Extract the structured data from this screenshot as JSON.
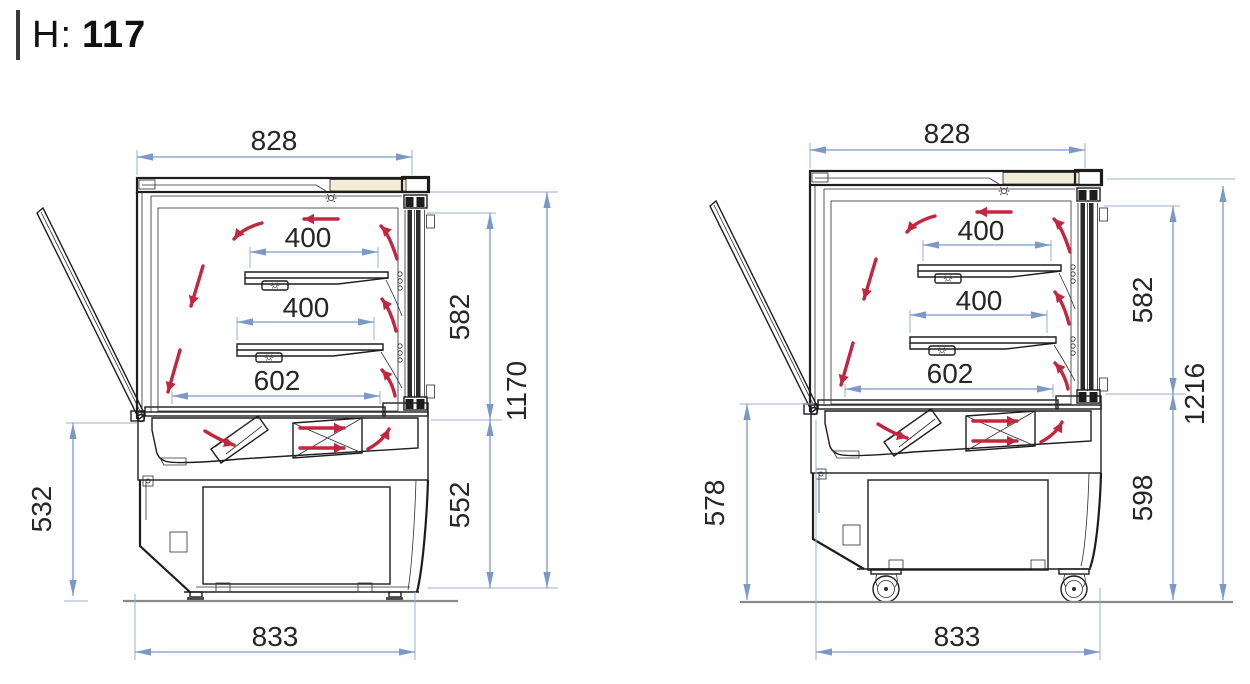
{
  "header": {
    "label": "H:",
    "value": "117"
  },
  "drawing": {
    "type": "refrigerated-display-case-cross-sections",
    "views": {
      "left": {
        "variant": "unit-on-adjustable-feet",
        "dims": {
          "top_width": "828",
          "shelf_upper": "400",
          "shelf_lower": "400",
          "interior_width": "602",
          "display_height": "582",
          "overall_height": "1170",
          "base_height": "552",
          "door_open_height": "532",
          "overall_width": "833"
        }
      },
      "right": {
        "variant": "unit-on-casters",
        "dims": {
          "top_width": "828",
          "shelf_upper": "400",
          "shelf_lower": "400",
          "interior_width": "602",
          "display_height": "582",
          "overall_height": "1216",
          "base_height": "598",
          "door_open_height": "578",
          "overall_width": "833"
        }
      }
    },
    "colors": {
      "dimension_blue": "#7a99c9",
      "airflow_red": "#c32740",
      "panel_beige": "#f2ecd8",
      "line_dark": "#1d1d1d",
      "ground_gray": "#8a8a8a"
    }
  }
}
